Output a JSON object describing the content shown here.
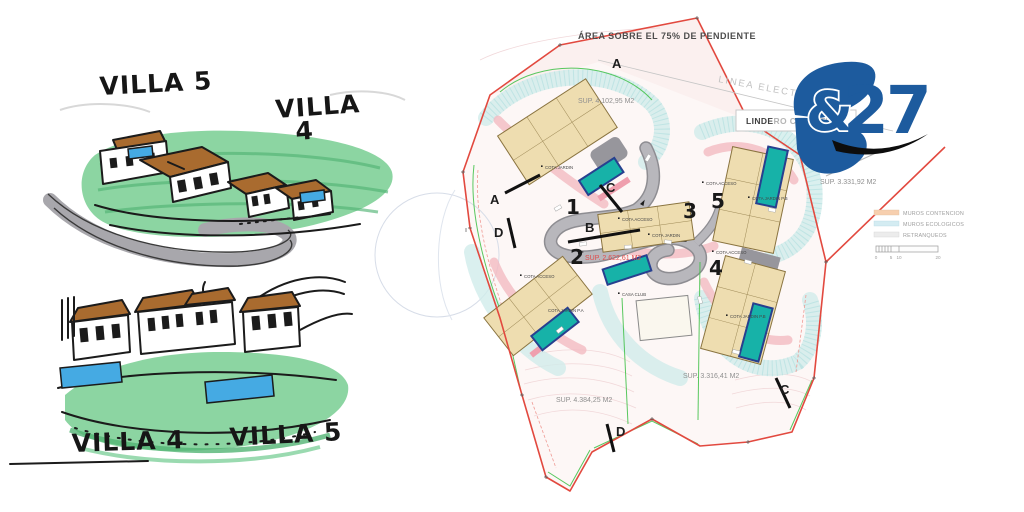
{
  "colors": {
    "logo_blue": "#1d5b9e",
    "boundary_red": "#e2493f",
    "plot_green": "#46c24e",
    "pool_teal": "#17b2a8",
    "building_tan": "#eeddb0",
    "contencion_pink": "#f2bac2",
    "ecologico_cyan": "#cfeceb",
    "road_gray": "#b8b7bc",
    "sketch_green": "#7fd098",
    "sketch_pool_blue": "#45aae3",
    "sketch_roof_brown": "#a96b2f"
  },
  "sketches": {
    "top": {
      "villa5_label": "VILLA 5",
      "villa4_label_line1": "VILLA",
      "villa4_label_line2": "4"
    },
    "bottom": {
      "villa4_label": "VILLA 4",
      "villa5_label": "VILLA 5"
    }
  },
  "plan": {
    "title": "ÁREA SOBRE EL 75% DE PENDIENTE",
    "power_line_label": "LINEA  ELECTRICA",
    "boundary_box": {
      "label_strong": "LINDE",
      "label_rest": "RO CATASTRAL"
    },
    "logo": {
      "amp": "&",
      "num": "27"
    },
    "plot_numbers": [
      "1",
      "2",
      "3",
      "4",
      "5"
    ],
    "section_letters": {
      "a_top": "A",
      "a_left": "A",
      "b_center": "B",
      "b_right": "B",
      "c_center": "C",
      "c_bottom": "C",
      "d_left": "D",
      "d_bottom": "D"
    },
    "area_labels": {
      "plot1": "SUP. 4.102,95 M2",
      "plot2": "SUP. 2.622,61 M2",
      "plot4": "SUP. 3.316,41 M2",
      "plot5": "SUP. 3.331,92 M2",
      "south": "SUP. 4.384,25 M2"
    },
    "cota_labels": {
      "p1_jardin": "COTA JARDIN",
      "p2_acceso": "COTA ACCESO",
      "p2_jardin": "COTA JARDIN P.A",
      "p3_acceso": "COTA ACCESO",
      "p3_jardin": "COTA JARDIN",
      "p4_acceso": "COTA ACCESO",
      "p4_jardin": "COTA JARDIN P.B",
      "p5_acceso": "COTA ACCESO",
      "p5_jardin": "COTA JARDIN P.B",
      "casa_club": "CASA CLUB"
    },
    "legend": {
      "items": [
        {
          "label": "MUROS CONTENCION",
          "color": "#f7cfae"
        },
        {
          "label": "MUROS ECOLOGICOS",
          "color": "#d4ecf2"
        },
        {
          "label": "RETRANQUEOS",
          "color": "#ececec"
        }
      ],
      "scale_ticks": [
        "0",
        "5",
        "10",
        "20"
      ]
    }
  }
}
